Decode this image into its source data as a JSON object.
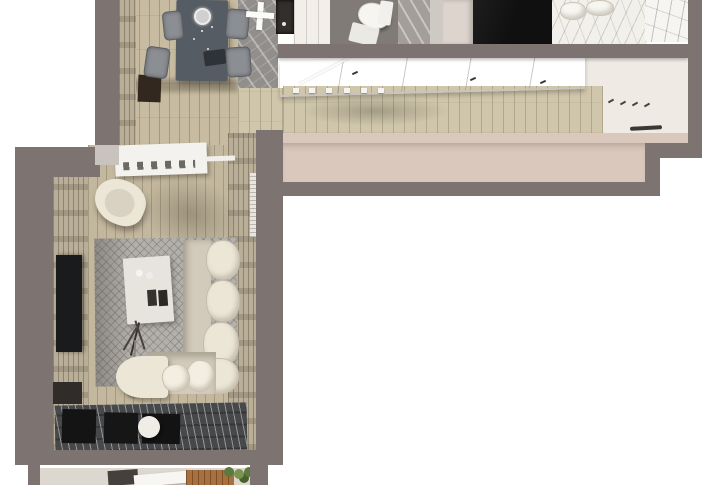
{
  "meta": {
    "image_type": "3d-floor-plan-render",
    "view": "top-down axonometric apartment visualization",
    "text_content": "none — image contains no visible text, labels or UI controls"
  },
  "palette": {
    "bg": "#ffffff",
    "wall": "#7d7472",
    "wall-light": "#c9c3bd",
    "wood-dining": "#c7bca1",
    "wood-living": "#c3b89e",
    "wood-hall": "#cfc6ab",
    "slat-wall": "#b9ae97",
    "beige-face": "#d9c8bb",
    "end-wall": "#efeae4",
    "closet": "#f2efea",
    "marble": "#928e8b",
    "marble-light": "#a49e99",
    "bath-floor": "#807b77",
    "dark-floor": "#101010",
    "bed": "#f2f0ea",
    "table": "#565c63",
    "chair": "#8b8e93",
    "cream": "#ece6d7",
    "cream-dark": "#d2caba",
    "white-obj": "#f4f2ee",
    "carpet": "#b3b0ab",
    "tv": "#1a1b1d",
    "slat-dark": "#47484a",
    "deck": "#a86f3f",
    "plant": "#5c7a3e",
    "plant-light": "#7a934f"
  },
  "rooms": [
    {
      "name": "kitchen-dining",
      "furniture": [
        "dining-table",
        "dining-chair x4",
        "pendant-lamp",
        "cross-ceiling-lamp",
        "refrigerator",
        "tall-cabinet",
        "marble-floor",
        "wood-floor"
      ]
    },
    {
      "name": "bathroom",
      "furniture": [
        "toilet",
        "bath-mat",
        "stone-floor"
      ]
    },
    {
      "name": "bedroom",
      "furniture": [
        "double-bed",
        "pillows",
        "dark-floor",
        "dresser-strip"
      ]
    },
    {
      "name": "hallway",
      "furniture": [
        "sliding-wardrobes",
        "coat-hooks",
        "wall-shelf",
        "wood-floor"
      ]
    },
    {
      "name": "living-room",
      "furniture": [
        "media-console",
        "armchair",
        "coffee-table",
        "corner-sofa",
        "bolster-pillows",
        "chaise",
        "rug",
        "tv",
        "tv-cabinet",
        "floor-lamp",
        "branch-decor",
        "stool",
        "slatted-lounge-floor"
      ]
    },
    {
      "name": "balcony",
      "furniture": [
        "wooden-deck",
        "plants",
        "outdoor-table",
        "dark-crate"
      ]
    }
  ],
  "counts": {
    "dining_chairs": 4,
    "sofa_back_pillows": 4,
    "wardrobe_feet": 6,
    "coat_hooks": 4,
    "floor_gaps": 3
  }
}
